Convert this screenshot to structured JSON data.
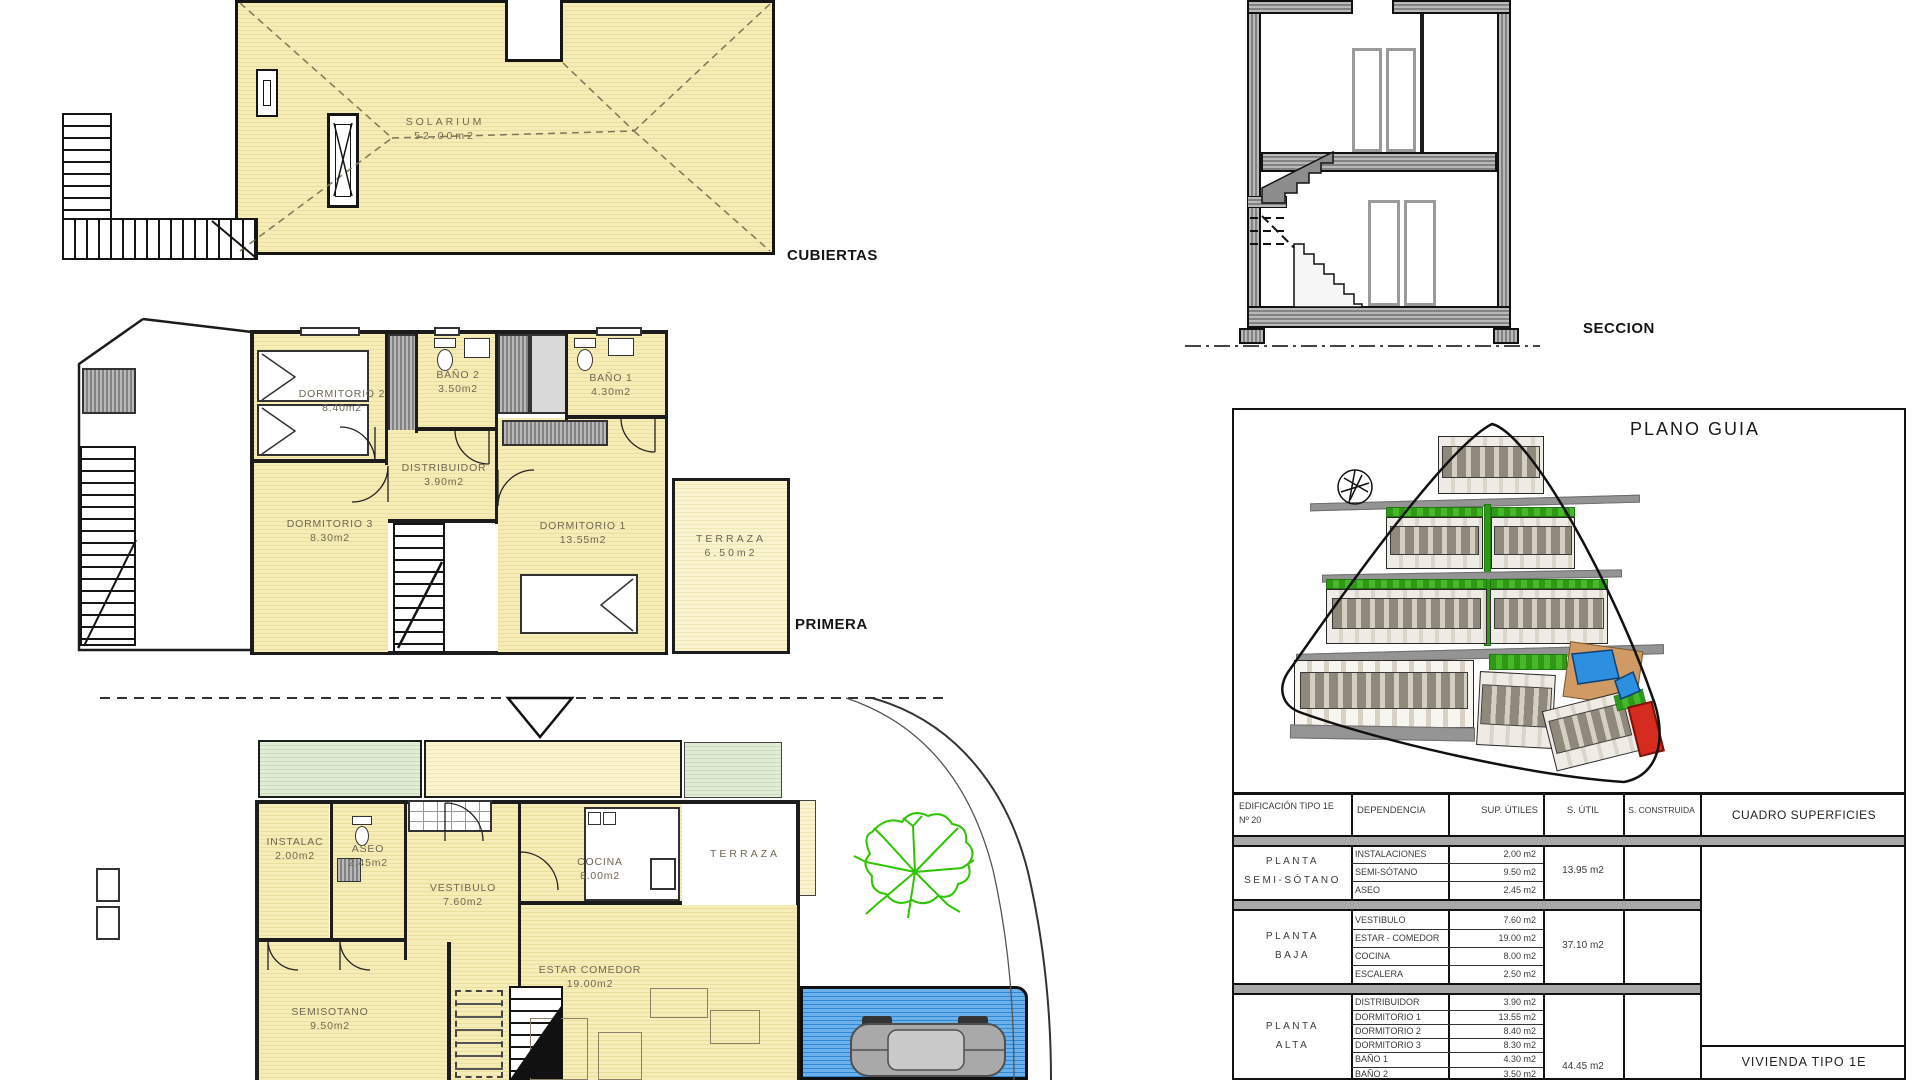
{
  "colors": {
    "room_fill": "#f4e9b0",
    "hatch_gray": "#8a8a8a",
    "green": "#3fae1f",
    "pool_blue": "#2d8fe0",
    "highlight_red": "#d62b1f",
    "wall": "#1c1c1c"
  },
  "roof_plan": {
    "title": "CUBIERTAS",
    "solarium": {
      "name": "SOLARIUM",
      "area": "52.00m2"
    }
  },
  "first_floor": {
    "title": "PRIMERA",
    "rooms": {
      "dormitorio2": {
        "name": "DORMITORIO 2",
        "area": "8.40m2"
      },
      "bano2": {
        "name": "BAÑO 2",
        "area": "3.50m2"
      },
      "bano1": {
        "name": "BAÑO 1",
        "area": "4.30m2"
      },
      "distribuidor": {
        "name": "DISTRIBUIDOR",
        "area": "3.90m2"
      },
      "dormitorio3": {
        "name": "DORMITORIO 3",
        "area": "8.30m2"
      },
      "dormitorio1": {
        "name": "DORMITORIO 1",
        "area": "13.55m2"
      },
      "terraza": {
        "name": "TERRAZA",
        "area": "6.50m2"
      }
    }
  },
  "ground_floor": {
    "rooms": {
      "instalac": {
        "name": "INSTALAC",
        "area": "2.00m2"
      },
      "aseo": {
        "name": "ASEO",
        "area": "2.45m2"
      },
      "vestibulo": {
        "name": "VESTIBULO",
        "area": "7.60m2"
      },
      "cocina": {
        "name": "COCINA",
        "area": "8.00m2"
      },
      "estar": {
        "name": "ESTAR COMEDOR",
        "area": "19.00m2"
      },
      "semisotano": {
        "name": "SEMISOTANO",
        "area": "9.50m2"
      },
      "terraza": {
        "name": "TERRAZA"
      }
    }
  },
  "section": {
    "title": "SECCION"
  },
  "site_plan": {
    "title": "PLANO GUIA"
  },
  "surfaces_table": {
    "title": "CUADRO SUPERFICIES",
    "building_line1": "EDIFICACIÓN TIPO 1E",
    "building_line2": "Nº 20",
    "col_dependencia": "DEPENDENCIA",
    "col_sup_utiles": "SUP. ÚTILES",
    "col_s_util": "S. ÚTIL",
    "col_s_construida": "S. CONSTRUIDA",
    "groups": [
      {
        "floor_line1": "PLANTA",
        "floor_line2": "SEMI-SÓTANO",
        "s_util": "13.95 m2",
        "rows": [
          {
            "name": "INSTALACIONES",
            "area": "2.00 m2"
          },
          {
            "name": "SEMI-SÓTANO",
            "area": "9.50 m2"
          },
          {
            "name": "ASEO",
            "area": "2.45 m2"
          }
        ]
      },
      {
        "floor_line1": "PLANTA",
        "floor_line2": "BAJA",
        "s_util": "37.10 m2",
        "rows": [
          {
            "name": "VESTIBULO",
            "area": "7.60 m2"
          },
          {
            "name": "ESTAR - COMEDOR",
            "area": "19.00 m2"
          },
          {
            "name": "COCINA",
            "area": "8.00 m2"
          },
          {
            "name": "ESCALERA",
            "area": "2.50 m2"
          }
        ]
      },
      {
        "floor_line1": "PLANTA",
        "floor_line2": "ALTA",
        "s_util": "44.45 m2",
        "rows": [
          {
            "name": "DISTRIBUIDOR",
            "area": "3.90 m2"
          },
          {
            "name": "DORMITORIO 1",
            "area": "13.55 m2"
          },
          {
            "name": "DORMITORIO 2",
            "area": "8.40 m2"
          },
          {
            "name": "DORMITORIO 3",
            "area": "8.30 m2"
          },
          {
            "name": "BAÑO 1",
            "area": "4.30 m2"
          },
          {
            "name": "BAÑO 2",
            "area": "3.50 m2"
          }
        ]
      }
    ],
    "footer": "VIVIENDA TIPO 1E"
  }
}
